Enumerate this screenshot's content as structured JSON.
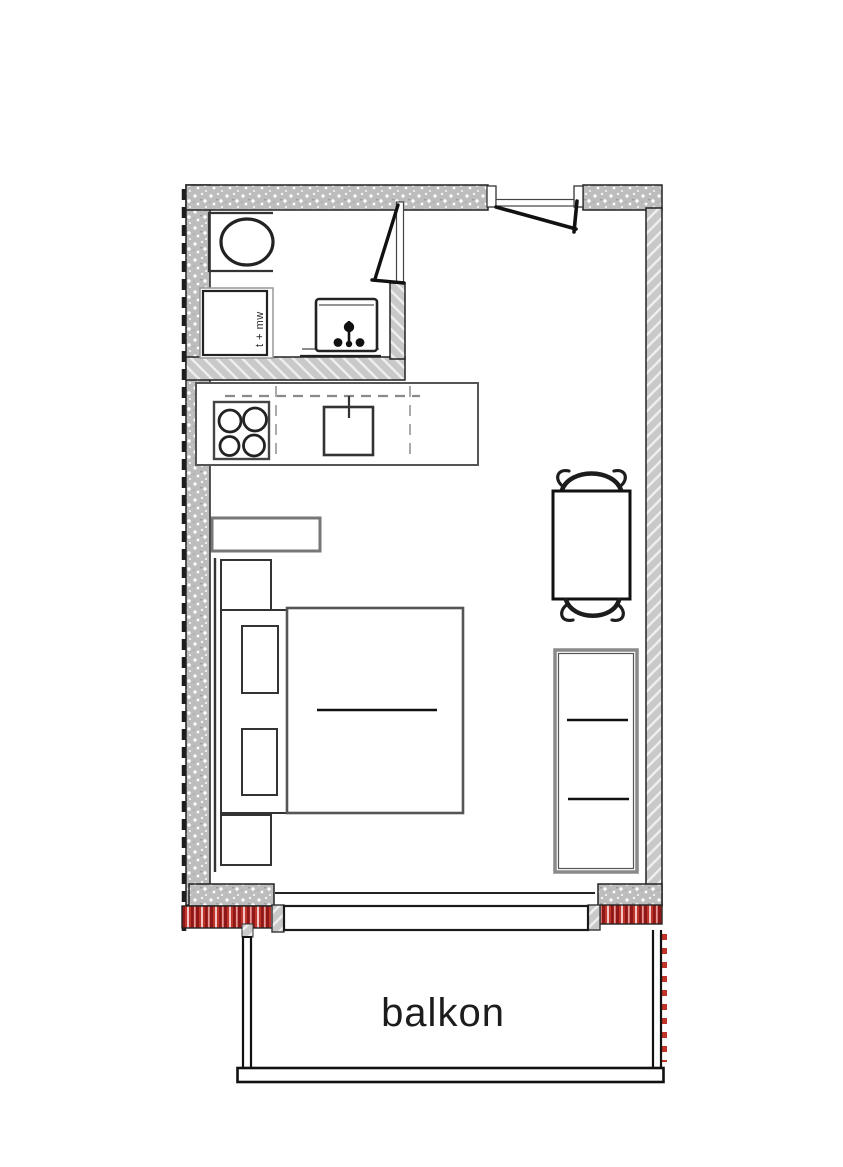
{
  "meta": {
    "title": "studio apartment floor plan",
    "canvas": {
      "width": 843,
      "height": 1167
    }
  },
  "labels": {
    "balcony": "balkon",
    "washer": "t + mw"
  },
  "rooms": [
    {
      "name": "bathroom",
      "fixtures": [
        "toilet",
        "washer-dryer",
        "washbasin",
        "swing-door"
      ]
    },
    {
      "name": "kitchen",
      "fixtures": [
        "counter",
        "four-burner-stove",
        "sink-with-tap",
        "upper-cabinet-dashed-line"
      ]
    },
    {
      "name": "living-room",
      "fixtures": [
        "entry-door",
        "wall-shelf",
        "bed",
        "pillow",
        "pillow",
        "nightstand",
        "nightstand",
        "dining-table",
        "chair",
        "chair",
        "sideboard"
      ]
    },
    {
      "name": "balcony",
      "fixtures": [
        "sliding-window",
        "railing"
      ]
    }
  ],
  "colors": {
    "wall-gray": "#bdbdbd",
    "hatch-gray": "#c9c9c9",
    "line-dark": "#1a1a1a",
    "red-dark": "#8e1818",
    "red-mid": "#c0342a",
    "red-light": "#f0c6c6",
    "text": "#1c1c1c"
  }
}
